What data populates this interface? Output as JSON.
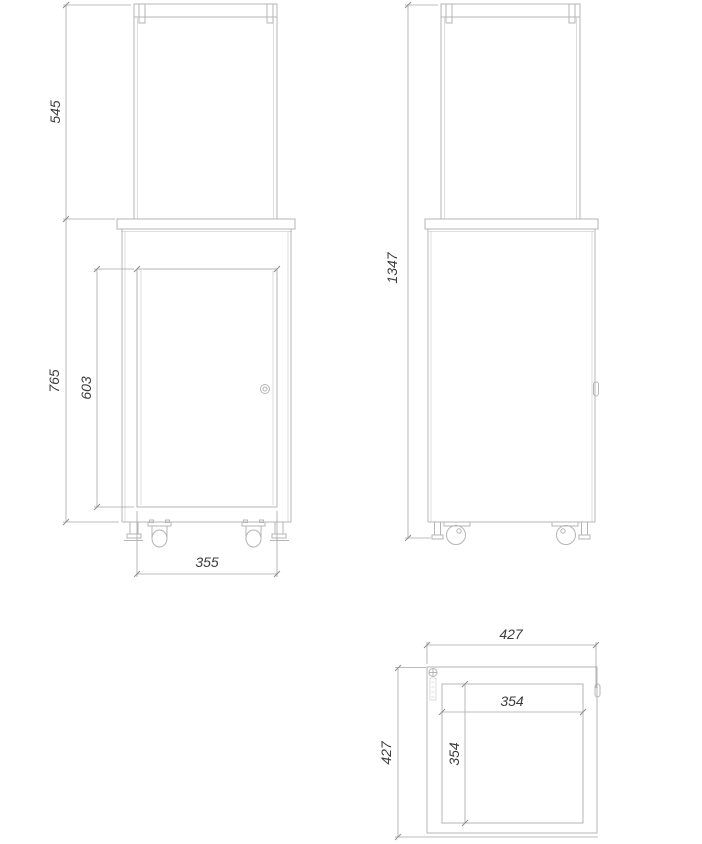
{
  "drawing": {
    "colors": {
      "object_line": "#b5b5b5",
      "dimension_line": "#a6a6a6",
      "text": "#3c3c3c",
      "background": "#ffffff"
    },
    "views": {
      "front": {
        "dims": {
          "glass_height": "545",
          "body_height": "765",
          "door_height": "603",
          "door_width": "355"
        }
      },
      "side": {
        "dims": {
          "total_height": "1347"
        }
      },
      "top": {
        "dims": {
          "outer_width": "427",
          "outer_depth": "427",
          "inner_width": "354",
          "inner_depth": "354"
        }
      }
    }
  }
}
